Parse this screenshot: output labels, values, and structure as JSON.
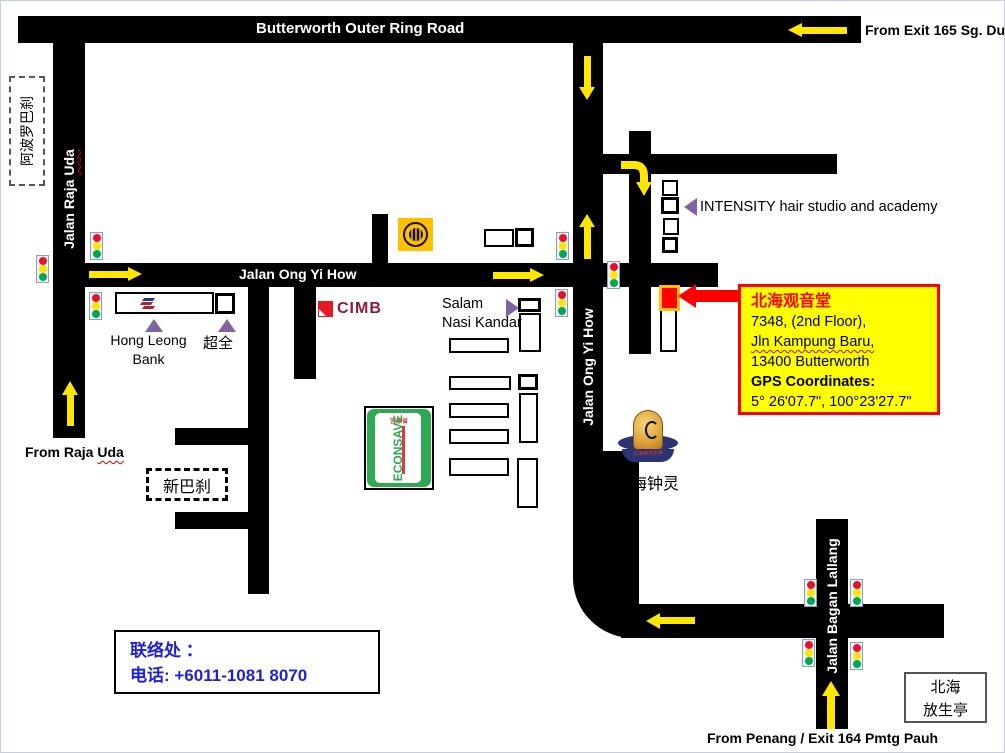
{
  "roads": {
    "ring_road": "Butterworth Outer Ring Road",
    "ong_yi_how_horizontal": "Jalan Ong Yi How",
    "ong_yi_how_vertical": "Jalan Ong Yi How",
    "raja_uda_prefix": "Jalan Raja ",
    "raja_uda_suffix": "Uda",
    "bagan_lallang": "Jalan Bagan Lallang"
  },
  "directions": {
    "from_exit_165": "From Exit 165 Sg. Dua",
    "from_raja_uda_prefix": "From Raja ",
    "from_raja_uda_suffix": "Uda",
    "from_penang": "From Penang / Exit 164 Pmtg Pauh"
  },
  "landmarks": {
    "apollo_market": "阿波罗巴刹",
    "hong_leong_line1": "Hong Leong",
    "hong_leong_line2": "Bank",
    "chao_quan": "超全",
    "cimb": "CIMB",
    "salam_line1": "Salam",
    "salam_line2": "Nasi Kandar",
    "econsave": "ECONSAVE",
    "econsave_cn": "宜康省",
    "new_market": "新巴刹",
    "intensity": "INTENSITY hair studio and academy",
    "chung_ling": "北海钟灵",
    "badge_text": "北海钟灵中学",
    "fang_sheng_line1": "北海",
    "fang_sheng_line2": "放生亭"
  },
  "destination": {
    "name": "北海观音堂",
    "address_line1": "7348, (2nd Floor),",
    "address_line2": "Jln Kampung Baru,",
    "address_line3": "13400 Butterworth",
    "gps_label": "GPS Coordinates:",
    "gps_value": "5° 26'07.7\", 100°23'27.7\""
  },
  "contact": {
    "line1": "联络处  ：",
    "line2": "电话: +6011-1081 8070"
  },
  "colors": {
    "road": "#000000",
    "arrow_yellow": "#ffe600",
    "callout_bg": "#ffff00",
    "callout_border": "#ff0000",
    "destination_red": "#ff0000",
    "marker_border_orange": "#ffc000",
    "contact_blue": "#1f1fd4",
    "purple_triangle": "#8064a2",
    "traffic_red": "#e8112d",
    "traffic_yellow": "#ffe600",
    "traffic_green": "#00a651",
    "cimb_red": "#e31b23",
    "cimb_text": "#8d1b3d",
    "econsave_green": "#2fa84f",
    "maybank_orange": "#ffc000"
  }
}
